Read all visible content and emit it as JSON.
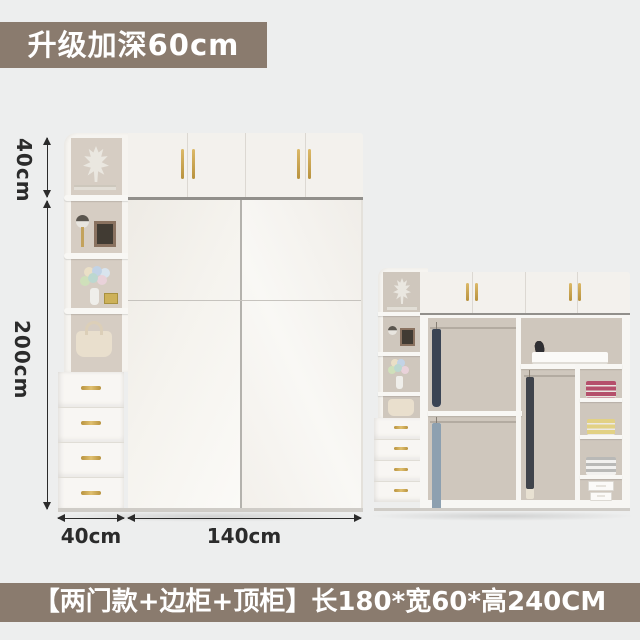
{
  "top_banner": {
    "text": "升级加深60cm"
  },
  "bottom_banner": {
    "text": "【两门款+边柜+顶柜】长180*宽60*高240CM"
  },
  "dimensions": {
    "top_cabinet_height": "40cm",
    "body_height": "200cm",
    "side_cabinet_width": "40cm",
    "main_width": "140cm"
  },
  "colors": {
    "background": "#edeeee",
    "banner": "#8a7b6e",
    "banner_text": "#ffffff",
    "ink": "#2b2b2b",
    "wardrobe_white": "#f6f4f0",
    "wardrobe_shade": "#eceae5",
    "cabinet_interior": "#d6cdc3",
    "open_interior": "#cfc7bd",
    "handle_gold": "#c9a54f",
    "gap_dark": "#918f8b",
    "stack_pink": "#b5506c",
    "stack_yellow": "#e2d184",
    "stack_gray": "#b9b9b7"
  },
  "open_wardrobe": {
    "shirts_top": [
      "#f3f2f0",
      "#9fb0c2",
      "#f6f4f2",
      "#ece0e6",
      "#f5f3f1",
      "#eceae9",
      "#95a3b3",
      "#3a4454"
    ],
    "clothes_bottom": [
      "#f1ebe0",
      "#f4eee3",
      "#efe9dd",
      "#f2ecdf",
      "#ede6d9",
      "#f1eadd",
      "#aebdc9",
      "#8da0b0"
    ],
    "pants": [
      "#f4f2ee",
      "#e8e1d2",
      "#cfc8ba",
      "#787878",
      "#40444c"
    ],
    "shoes": [
      "#7a5c4a",
      "#3c3c3c",
      "#8d7260",
      "#52423a",
      "#6b4f41",
      "#2f2f33"
    ]
  }
}
